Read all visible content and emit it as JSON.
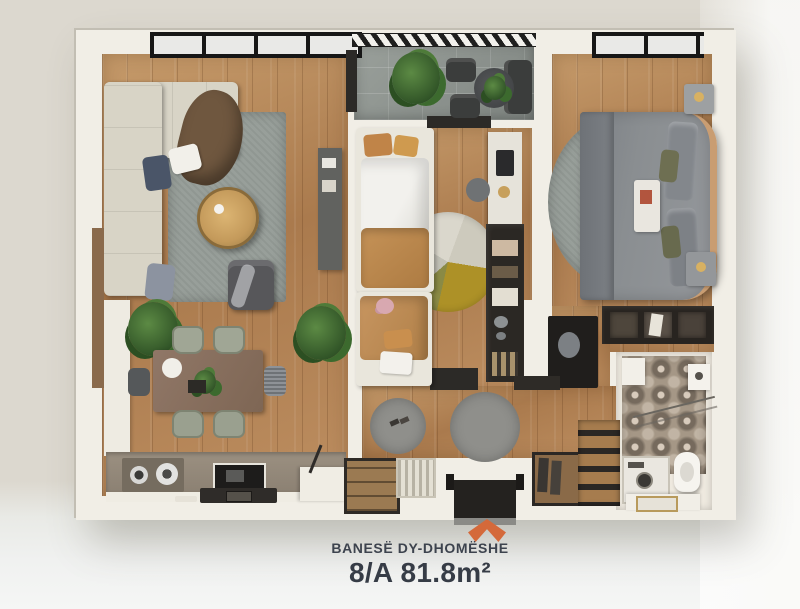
{
  "caption": {
    "apartment_type": "BANESË DY-DHOMËSHE",
    "unit_area": "8/A 81.8m²",
    "chevron_style": "background:#D4693A;"
  },
  "colors": {
    "accent_orange": "#D4693A",
    "caption_text": "#3A4049",
    "background_beige": "#DCD8CF",
    "background_gray": "#F0F1F0",
    "wall_white": "#F1EEE6",
    "floor_wood": "#B08055",
    "balcony_tile": "#8E948F",
    "rug_gray": "#989F9A",
    "bed_duvet_gray": "#8A8E91",
    "kids_duvet_mustard": "#C29057"
  },
  "icons": {
    "entrance_marker": "chevron-up-icon"
  }
}
